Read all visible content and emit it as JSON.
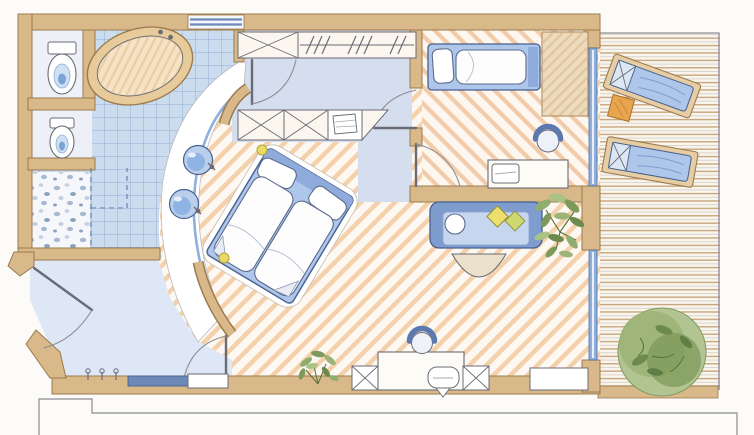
{
  "drawing": {
    "kind": "hand-drawn watercolor floor plan",
    "palette": {
      "paper": "#fcfbf8",
      "wall": "#d9b88a",
      "wall_edge": "#9b7b4e",
      "tile_floor": "#cbdcee",
      "tile_line": "#92b1d6",
      "wood_base": "#fdf8f2",
      "wood_stripe": "#f4d0ab",
      "wash_dressing": "#d5deef",
      "wash_hall": "#dde7f5",
      "deck_base": "#f8f4ee",
      "deck_line": "#c9a478",
      "furniture_blue": "#aec6ea",
      "furniture_blue_deep": "#7e9ccd",
      "outline_blue": "#46608f",
      "glass_blue": "#8fb0dc",
      "ink": "#6b6b75",
      "ink_soft": "#8c8c94",
      "cream": "#f6e3c4",
      "plant_green": "#8fae6e",
      "plant_green_dark": "#5f7f46",
      "accent_yellow": "#ead964",
      "accent_orange": "#e8a54e",
      "pebble_blue": "#a8b8d0"
    },
    "rooms": [
      {
        "id": "bathroom",
        "floor": "blue-tile-grid",
        "fixtures": [
          "bathtub",
          "toilet",
          "bidet",
          "shower-pebble-floor",
          "curved-vanity",
          "sink",
          "sink",
          "mirror-strip"
        ]
      },
      {
        "id": "dressing-area",
        "floor": "pale-blue-wash",
        "fixtures": [
          "wardrobe-x-cabinet",
          "hanging-rail-with-hangers",
          "wardrobe-x-cabinet",
          "wardrobe-x-cabinet",
          "console-with-towels"
        ]
      },
      {
        "id": "master-bedroom",
        "floor": "diagonal-wood-stripes",
        "fixtures": [
          "double-bed",
          "curved-headboard-wall",
          "ceiling-spot",
          "ceiling-spot",
          "plant",
          "x-stool",
          "desk",
          "tucked-chair",
          "tub-chair",
          "x-stool",
          "sideboard"
        ]
      },
      {
        "id": "living-area",
        "floor": "diagonal-wood-stripes",
        "fixtures": [
          "sofa",
          "round-cushion",
          "diamond-cushion",
          "diamond-cushion",
          "coffee-table-semicircle",
          "plant"
        ]
      },
      {
        "id": "second-bedroom",
        "floor": "diagonal-wood-stripes",
        "fixtures": [
          "single-bed",
          "tall-cabinet",
          "desk",
          "laptop",
          "tub-chair"
        ]
      },
      {
        "id": "entrance-hall",
        "floor": "pale-blue-wash",
        "fixtures": [
          "coat-hooks",
          "bench",
          "low-cabinet"
        ]
      },
      {
        "id": "balcony",
        "floor": "horizontal-deck-planks",
        "fixtures": [
          "sun-lounger",
          "sun-lounger",
          "side-table",
          "large-plant"
        ]
      }
    ],
    "openings": [
      "entry-door",
      "bathroom-door",
      "hall-bedroom-door",
      "corridor-bedroom2-door",
      "corridor-living-door",
      "window",
      "glass-wall",
      "shower-screen-dashed"
    ]
  }
}
